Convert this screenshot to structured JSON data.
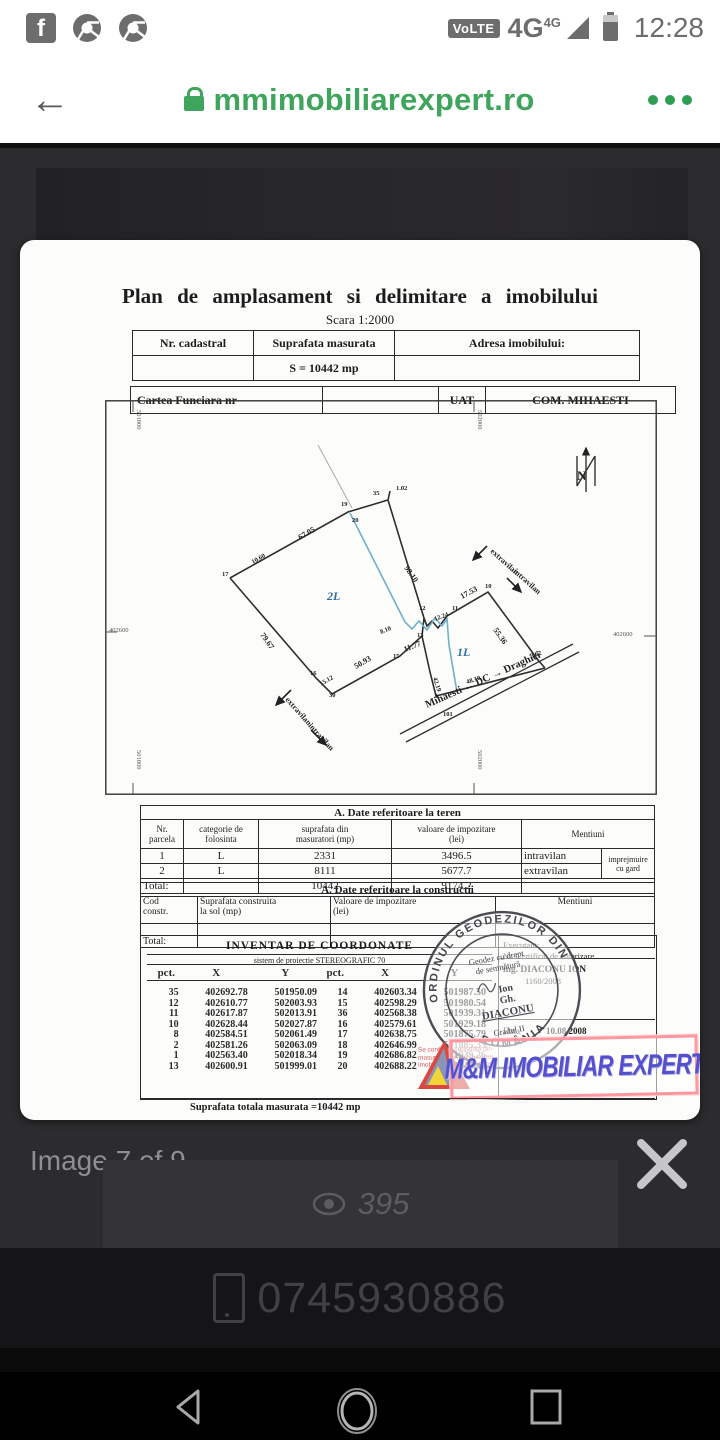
{
  "status_bar": {
    "time": "12:28",
    "volte": "VoLTE",
    "network": "4G",
    "network_sup": "4G",
    "fb": "f"
  },
  "browser": {
    "url": "mmimobiliarexpert.ro"
  },
  "viewer": {
    "counter": "Image 7 of 9",
    "views": "395"
  },
  "contact": {
    "phone": "0745930886"
  },
  "colors": {
    "url_green": "#3fa55c",
    "watermark_blue": "#5551cd",
    "watermark_border": "#ff97a0",
    "plot_blue": "#6fb1c9"
  },
  "doc": {
    "title": "Plan  de  amplasament  si  delimitare  a  imobilului",
    "scale": "Scara  1:2000",
    "header_table": {
      "nr_cadastral": "Nr. cadastral",
      "suprafata": "Suprafata  masurata",
      "adresa": "Adresa  imobilului:",
      "area_value": "S = 10442 mp",
      "cartea": "Cartea  Funciara  nr",
      "uat_label": "UAT",
      "uat_value": "COM. MIHAESTI"
    },
    "teren": {
      "caption": "A.  Date  referitoare  la  teren",
      "h0": "Nr.\nparcela",
      "h1": "categorie de\nfolosinta",
      "h2": "suprafata  din\nmasuratori (mp)",
      "h3": "valoare  de  impozitare\n(lei)",
      "h4": "Mentiuni",
      "rows": [
        {
          "nr": "1",
          "cat": "L",
          "sup": "2331",
          "val": "3496.5",
          "men": "intravilan"
        },
        {
          "nr": "2",
          "cat": "L",
          "sup": "8111",
          "val": "5677.7",
          "men": "extravilan"
        }
      ],
      "note": "imprejmuire cu gard",
      "total_label": "Total:",
      "total_sup": "10442",
      "total_val": "9174.2"
    },
    "constructii": {
      "caption": "A.  Date  referitoare  la  constructii",
      "h0": "Cod\nconstr.",
      "h1": "Suprafata construita\nla sol (mp)",
      "h2": "Valoare  de  impozitare\n(lei)",
      "h3": "Mentiuni",
      "total_label": "Total:"
    },
    "coords": {
      "title": "INVENTAR  DE  COORDONATE",
      "subtitle": "sistem  de  proiectie  STEREOGRAFIC    70",
      "pct": "pct.",
      "x": "X",
      "y": "Y",
      "left": [
        [
          "35",
          "402692.78",
          "501950.09"
        ],
        [
          "12",
          "402610.77",
          "502003.93"
        ],
        [
          "11",
          "402617.87",
          "502013.91"
        ],
        [
          "10",
          "402628.44",
          "502027.87"
        ],
        [
          "8",
          "402584.51",
          "502061.49"
        ],
        [
          "2",
          "402581.26",
          "502063.09"
        ],
        [
          "1",
          "402563.40",
          "502018.34"
        ],
        [
          "13",
          "402600.91",
          "501999.01"
        ]
      ],
      "right": [
        [
          "14",
          "402603.34",
          "501987.50"
        ],
        [
          "15",
          "402598.29",
          "501980.54"
        ],
        [
          "36",
          "402568.38",
          "501939.31"
        ],
        [
          "16",
          "402579.61",
          "501929.18"
        ],
        [
          "17",
          "402638.75",
          "501875.79"
        ],
        [
          "18",
          "402646.99",
          "501885.33"
        ],
        [
          "19",
          "402686.82",
          "501939.26"
        ],
        [
          "20",
          "402688.22",
          "501943.43"
        ]
      ]
    },
    "executant": {
      "line1": "Executant:",
      "line2": "Nr. Certificat de autorizare",
      "line3": "ing. DIACONU ION",
      "line4": "1160/2008",
      "data_label": "Data",
      "data_value": "10.08.2008"
    },
    "stamp": {
      "ring_top": "ORDINUL GEODEZILOR DIN",
      "ring_bottom": "ROMÂNIA",
      "l1": "Geodez cu drept",
      "l2": "de semnătură",
      "l3": "Ion",
      "l4": "Gh.",
      "l5": "DIACONU",
      "l6": "Gradul II"
    },
    "red_note": "Se confirma suprafata din masuratori si introducerea imobilului in baza de date",
    "watermark": "M&M IMOBILIAR EXPERT",
    "footer": "Suprafata totala  masurata  =10442 mp",
    "drawing": {
      "labels": [
        {
          "t": "67.05",
          "x": 195,
          "y": 140,
          "r": -30
        },
        {
          "t": "10.60",
          "x": 148,
          "y": 164,
          "r": -30,
          "c": "sm"
        },
        {
          "t": "19",
          "x": 236,
          "y": 106,
          "c": "sm"
        },
        {
          "t": "20",
          "x": 247,
          "y": 122,
          "c": "sm"
        },
        {
          "t": "35",
          "x": 268,
          "y": 95,
          "c": "sm"
        },
        {
          "t": "1.02",
          "x": 291,
          "y": 90,
          "c": "sm"
        },
        {
          "t": "98.10",
          "x": 299,
          "y": 168,
          "r": 55
        },
        {
          "t": "2L",
          "x": 222,
          "y": 200,
          "c": "blue"
        },
        {
          "t": "79.67",
          "x": 155,
          "y": 235,
          "r": 55
        },
        {
          "t": "17",
          "x": 117,
          "y": 176,
          "c": "sm"
        },
        {
          "t": "12",
          "x": 314,
          "y": 210,
          "c": "sm"
        },
        {
          "t": "12.24",
          "x": 330,
          "y": 221,
          "r": -20,
          "c": "sm"
        },
        {
          "t": "11",
          "x": 347,
          "y": 210,
          "c": "sm"
        },
        {
          "t": "17.53",
          "x": 357,
          "y": 199,
          "r": -28
        },
        {
          "t": "10",
          "x": 380,
          "y": 188,
          "c": "sm"
        },
        {
          "t": "13",
          "x": 312,
          "y": 237,
          "c": "sm"
        },
        {
          "t": "11.77",
          "x": 300,
          "y": 252,
          "r": -22
        },
        {
          "t": "8.10",
          "x": 276,
          "y": 234,
          "r": -22,
          "c": "sm"
        },
        {
          "t": "15",
          "x": 288,
          "y": 258,
          "c": "sm"
        },
        {
          "t": "50.93",
          "x": 251,
          "y": 269,
          "r": -30
        },
        {
          "t": "16",
          "x": 205,
          "y": 275,
          "c": "sm"
        },
        {
          "t": "15.12",
          "x": 216,
          "y": 286,
          "r": -30,
          "c": "sm"
        },
        {
          "t": "30",
          "x": 224,
          "y": 297,
          "c": "sm"
        },
        {
          "t": "1L",
          "x": 352,
          "y": 256,
          "c": "blue"
        },
        {
          "t": "55.36",
          "x": 388,
          "y": 230,
          "r": 55
        },
        {
          "t": "42.19",
          "x": 328,
          "y": 278,
          "r": 72,
          "c": "sm"
        },
        {
          "t": "48.10",
          "x": 362,
          "y": 284,
          "r": -18,
          "c": "sm"
        },
        {
          "t": "3.62",
          "x": 426,
          "y": 258,
          "r": -18,
          "c": "sm"
        },
        {
          "t": "1",
          "x": 330,
          "y": 298,
          "c": "sm"
        },
        {
          "t": "101",
          "x": 338,
          "y": 316,
          "c": "sm"
        },
        {
          "t": "Mihaesti ←  DC  → Draghici",
          "x": 322,
          "y": 308,
          "r": -24,
          "c": "road"
        },
        {
          "t": "extravilan",
          "x": 180,
          "y": 300,
          "r": 48
        },
        {
          "t": "intravilan",
          "x": 203,
          "y": 326,
          "r": 48
        },
        {
          "t": "extravilan",
          "x": 385,
          "y": 152,
          "r": 42
        },
        {
          "t": "intravilan",
          "x": 408,
          "y": 172,
          "r": 42
        },
        {
          "t": "402600",
          "x": 4,
          "y": 232,
          "c": "grid"
        },
        {
          "t": "402600",
          "x": 508,
          "y": 236,
          "c": "grid"
        },
        {
          "t": "501800",
          "x": 32,
          "y": 10,
          "r": 90,
          "c": "grid"
        },
        {
          "t": "502000",
          "x": 373,
          "y": 10,
          "r": 90,
          "c": "grid"
        },
        {
          "t": "501800",
          "x": 32,
          "y": 350,
          "r": 90,
          "c": "grid"
        },
        {
          "t": "502000",
          "x": 373,
          "y": 350,
          "r": 90,
          "c": "grid"
        },
        {
          "t": "N",
          "x": 472,
          "y": 80,
          "c": "north"
        }
      ]
    }
  }
}
